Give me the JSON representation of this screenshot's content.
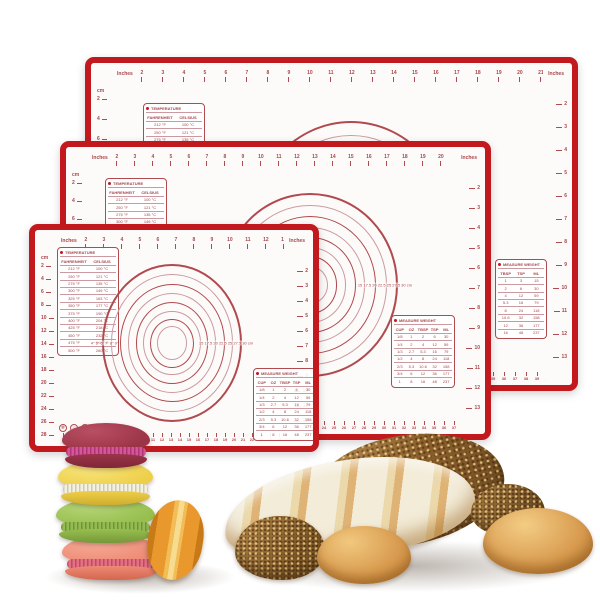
{
  "colors": {
    "matBorder": "#c2191f",
    "matBg": "#fdfbf9",
    "printRed": "#b04a4e",
    "printSoft": "#cb9aa0",
    "printText": "#a8474c",
    "flour": "#f3ecd8",
    "crust": "#dfb375",
    "golden": "#d89b4f"
  },
  "mat": {
    "inchesLabel": "Inches",
    "cmLabel": "cm",
    "topInches": [
      "2",
      "3",
      "4",
      "5",
      "6",
      "7",
      "8",
      "9",
      "10",
      "11",
      "12",
      "13",
      "14",
      "15",
      "16",
      "17",
      "18",
      "19",
      "20",
      "21"
    ],
    "leftCm": [
      "2",
      "4",
      "6",
      "8",
      "10",
      "12",
      "14",
      "16",
      "18",
      "20",
      "22",
      "24",
      "26",
      "28"
    ],
    "rightInches": [
      "2",
      "3",
      "4",
      "5",
      "6",
      "7",
      "8",
      "9",
      "10",
      "11",
      "12",
      "13"
    ],
    "bottomCm": [
      "1",
      "2",
      "3",
      "4",
      "5",
      "6",
      "7",
      "8",
      "9",
      "10",
      "11",
      "12",
      "13",
      "14",
      "15",
      "16",
      "17",
      "18",
      "19",
      "20",
      "21",
      "22",
      "23",
      "24",
      "25",
      "26",
      "27",
      "28",
      "29",
      "30",
      "31",
      "32",
      "33",
      "34",
      "35",
      "36",
      "37",
      "38",
      "39",
      "40",
      "41",
      "42",
      "43",
      "44",
      "45",
      "46"
    ],
    "ringLeft": "4\" 5\" 6\" 7\" 8\" 9\"",
    "ringRight": "15 17.5 20 22.5 25 27.5 30 cm",
    "temperature": {
      "title": "TEMPERATURE",
      "colF": "FAHRENHEIT",
      "colC": "CELSIUS",
      "rows": [
        [
          "212 °F",
          "100 °C"
        ],
        [
          "250 °F",
          "121 °C"
        ],
        [
          "275 °F",
          "135 °C"
        ],
        [
          "300 °F",
          "149 °C"
        ],
        [
          "325 °F",
          "163 °C"
        ],
        [
          "350 °F",
          "177 °C"
        ],
        [
          "375 °F",
          "190 °C"
        ],
        [
          "400 °F",
          "204 °C"
        ],
        [
          "425 °F",
          "218 °C"
        ],
        [
          "450 °F",
          "232 °C"
        ],
        [
          "475 °F",
          "246 °C"
        ],
        [
          "500 °F",
          "260 °C"
        ]
      ]
    },
    "measureWide": {
      "title": "MEASURE WEIGHT",
      "cols": [
        "CUP",
        "OZ",
        "TBSP",
        "TSP",
        "ML"
      ],
      "rows": [
        [
          "1/8",
          "1",
          "2",
          "6",
          "30"
        ],
        [
          "1/4",
          "2",
          "4",
          "12",
          "59"
        ],
        [
          "1/3",
          "2.7",
          "5.3",
          "16",
          "79"
        ],
        [
          "1/2",
          "4",
          "8",
          "24",
          "118"
        ],
        [
          "2/3",
          "5.3",
          "10.6",
          "32",
          "158"
        ],
        [
          "3/4",
          "6",
          "12",
          "36",
          "177"
        ],
        [
          "1",
          "8",
          "16",
          "48",
          "237"
        ]
      ]
    },
    "measureNarrow": {
      "title": "MEASURE WEIGHT",
      "cols": [
        "TBSP",
        "TSP",
        "ML"
      ],
      "rows": [
        [
          "1",
          "3",
          "15"
        ],
        [
          "2",
          "6",
          "30"
        ],
        [
          "4",
          "12",
          "59"
        ],
        [
          "5.3",
          "16",
          "79"
        ],
        [
          "8",
          "24",
          "118"
        ],
        [
          "10.6",
          "32",
          "158"
        ],
        [
          "12",
          "36",
          "177"
        ],
        [
          "16",
          "48",
          "237"
        ]
      ]
    },
    "careIcons": [
      {
        "name": "freezer-safe",
        "glyph": "❄"
      },
      {
        "name": "oven-safe",
        "glyph": "♨"
      },
      {
        "name": "no-knife",
        "glyph": "✕"
      },
      {
        "name": "food-safe",
        "glyph": "✿"
      },
      {
        "name": "dishwasher-safe",
        "glyph": "✓"
      }
    ]
  },
  "foods": {
    "macarons": [
      {
        "name": "burgundy",
        "shell": "#9c3448",
        "hi": "#b84f63",
        "fill": "#cf3f8a",
        "shellD": "#7e2638"
      },
      {
        "name": "yellow",
        "shell": "#eecf49",
        "hi": "#f7e47e",
        "fill": "#f3efd9",
        "shellD": "#d1ad2e"
      },
      {
        "name": "green",
        "shell": "#97bf4e",
        "hi": "#b5d578",
        "fill": "#85b13c",
        "shellD": "#75983a"
      },
      {
        "name": "salmon",
        "shell": "#ee8a75",
        "hi": "#f6ab96",
        "fill": "#e05c72",
        "shellD": "#d4664f"
      }
    ],
    "macaronSide": {
      "name": "orange",
      "shell": "#e8982d",
      "hi": "#f7dc8f",
      "fill": "#f2bc57",
      "shellD": "#c97a18"
    }
  }
}
